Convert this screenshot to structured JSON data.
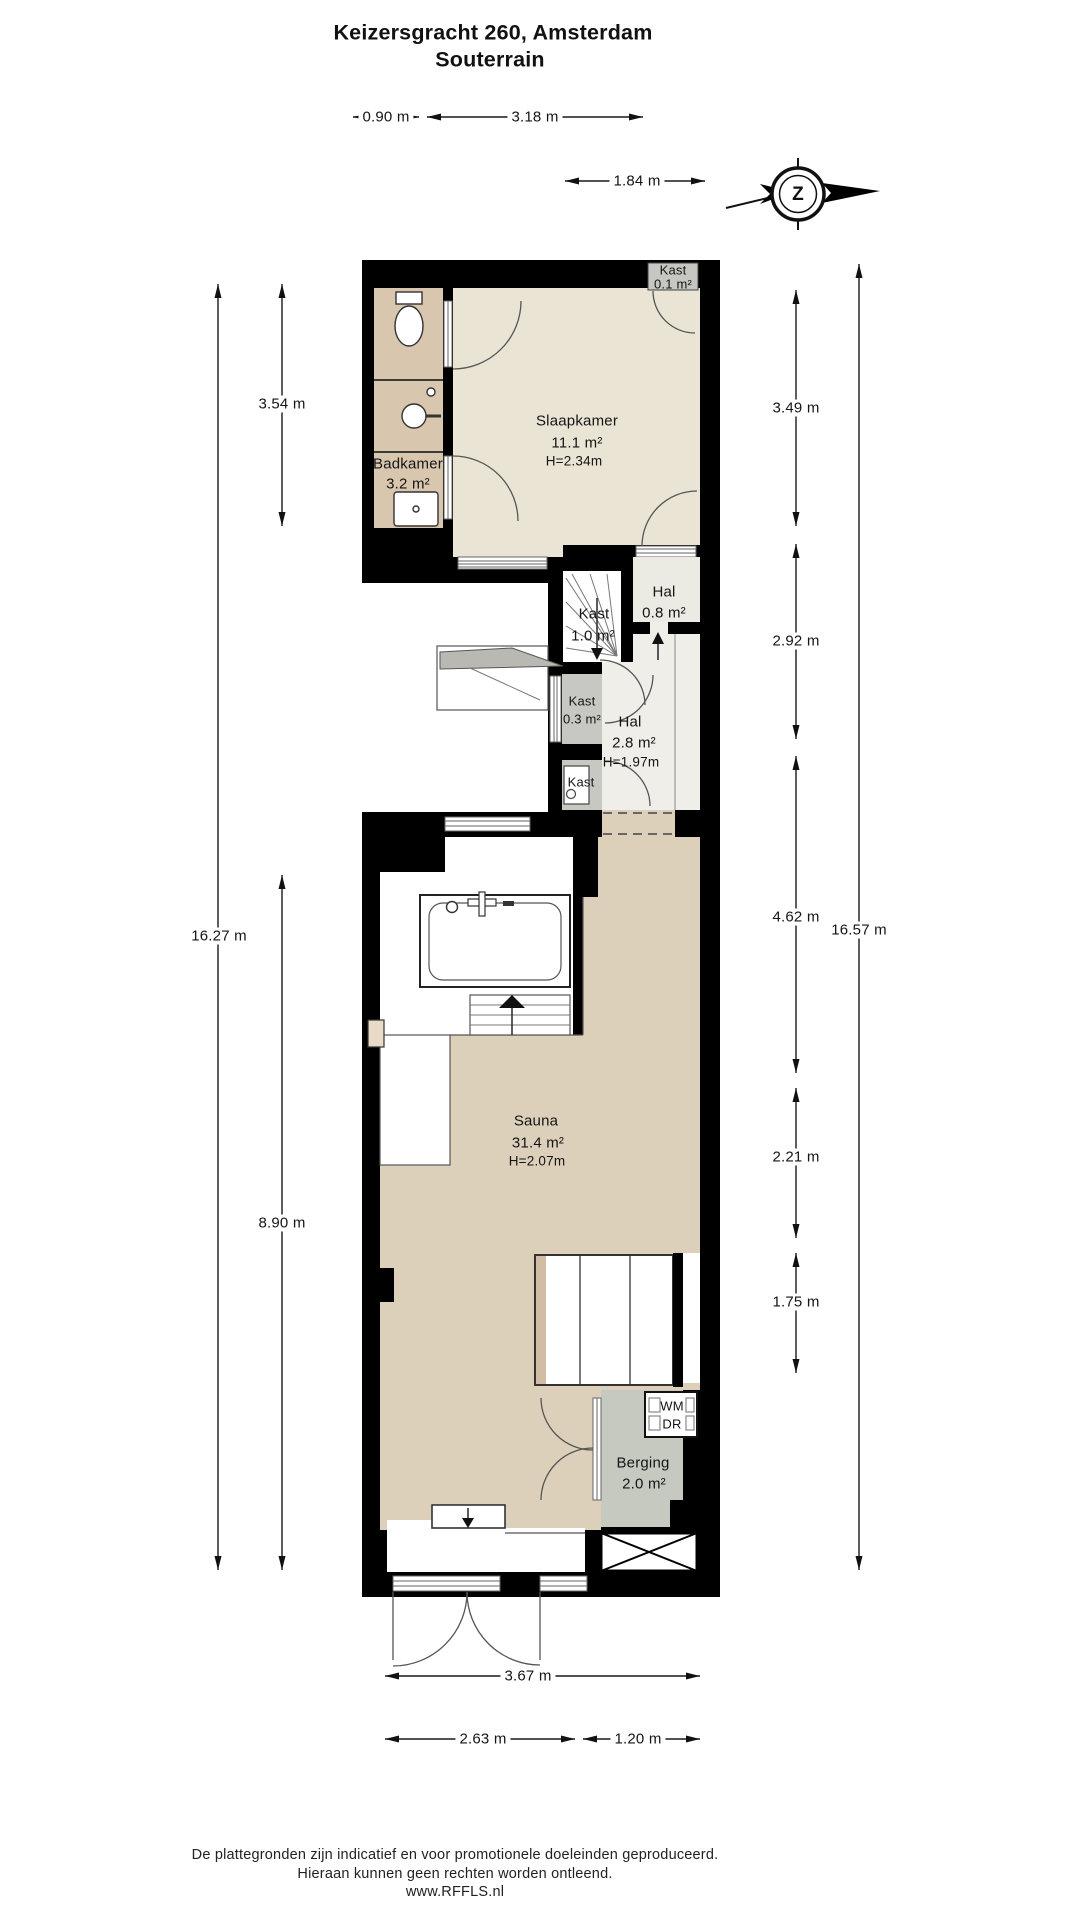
{
  "header": {
    "title": "Keizersgracht 260, Amsterdam",
    "subtitle": "Souterrain"
  },
  "compass": {
    "letter": "Z"
  },
  "rooms": {
    "slaapkamer": {
      "name": "Slaapkamer",
      "area": "11.1 m²",
      "height": "H=2.34m"
    },
    "badkamer": {
      "name": "Badkamer",
      "area": "3.2 m²"
    },
    "kast_top": {
      "name": "Kast",
      "area": "0.1 m²"
    },
    "kast_stairs": {
      "name": "Kast",
      "area": "1.0 m²"
    },
    "hal_small": {
      "name": "Hal",
      "area": "0.8 m²"
    },
    "kast_mid": {
      "name": "Kast",
      "area": "0.3 m²"
    },
    "hal_main": {
      "name": "Hal",
      "area": "2.8 m²",
      "height": "H=1.97m"
    },
    "kast_boiler": {
      "name": "Kast"
    },
    "sauna": {
      "name": "Sauna",
      "area": "31.4 m²",
      "height": "H=2.07m"
    },
    "berging": {
      "name": "Berging",
      "area": "2.0 m²"
    },
    "wm": "WM",
    "dr": "DR"
  },
  "dimensions": {
    "top": [
      "0.90 m",
      "3.18 m",
      "1.84 m"
    ],
    "left": [
      "3.54 m",
      "16.27 m",
      "8.90 m"
    ],
    "right": [
      "3.49 m",
      "2.92 m",
      "4.62 m",
      "2.21 m",
      "1.75 m",
      "16.57 m"
    ],
    "bottom": [
      "3.67 m",
      "2.63 m",
      "1.20 m"
    ]
  },
  "footer": {
    "line1": "De plattegronden zijn indicatief en voor promotionele doeleinden geproduceerd.",
    "line2": "Hieraan kunnen geen rechten worden ontleend.",
    "line3": "www.RFFLS.nl"
  },
  "colors": {
    "wall": "#000000",
    "bathroom_floor": "#d8c6ae",
    "bedroom_floor": "#eae4d4",
    "hall_floor": "#f0eee9",
    "closet_floor": "#c8c8c2",
    "sauna_floor": "#dcd0ba",
    "berging_floor": "#c6c9c0",
    "line": "#555555"
  }
}
